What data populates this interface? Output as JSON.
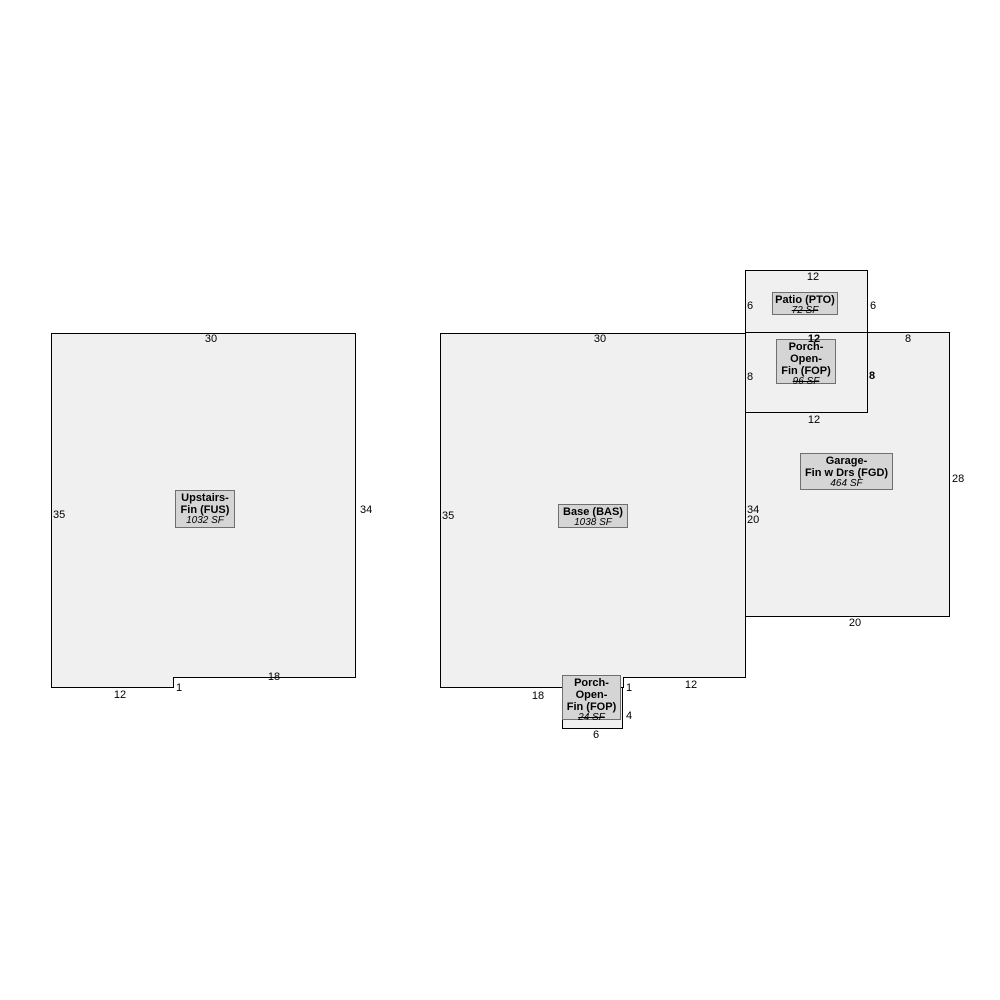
{
  "colors": {
    "background": "#ffffff",
    "shape_fill": "#f0f0f0",
    "shape_outline": "#000000",
    "label_fill": "#d5d5d5",
    "label_border": "#6f6f6f",
    "text": "#000000"
  },
  "shapes": {
    "fus": {
      "label": [
        "Upstairs-",
        "Fin (FUS)"
      ],
      "area": "1032 SF",
      "dims": {
        "top": "30",
        "left": "35",
        "right": "34",
        "bottom_right": "18",
        "step": "1",
        "bottom_left": "12"
      }
    },
    "bas": {
      "label": [
        "Base (BAS)"
      ],
      "area": "1038 SF",
      "dims": {
        "top": "30",
        "left": "35",
        "right": "34",
        "bottom_left": "18",
        "step": "1",
        "bottom_right": "12"
      }
    },
    "porch_fop_lower": {
      "label": [
        "Porch-",
        "Open-",
        "Fin (FOP)"
      ],
      "area": "24 SF",
      "dims": {
        "right": "4",
        "bottom": "6"
      }
    },
    "patio": {
      "label": [
        "Patio (PTO)"
      ],
      "area": "72 SF",
      "dims": {
        "top": "12",
        "left": "6",
        "right": "6"
      }
    },
    "porch_fop_upper": {
      "label": [
        "Porch-",
        "Open-",
        "Fin (FOP)"
      ],
      "area": "96 SF",
      "dims": {
        "top": "12",
        "left": "8",
        "right": "8",
        "bottom": "12"
      }
    },
    "garage": {
      "label": [
        "Garage-",
        "Fin w Drs (FGD)"
      ],
      "area": "464 SF",
      "dims": {
        "top_right": "8",
        "right": "28",
        "bottom": "20",
        "left": "20"
      }
    }
  }
}
